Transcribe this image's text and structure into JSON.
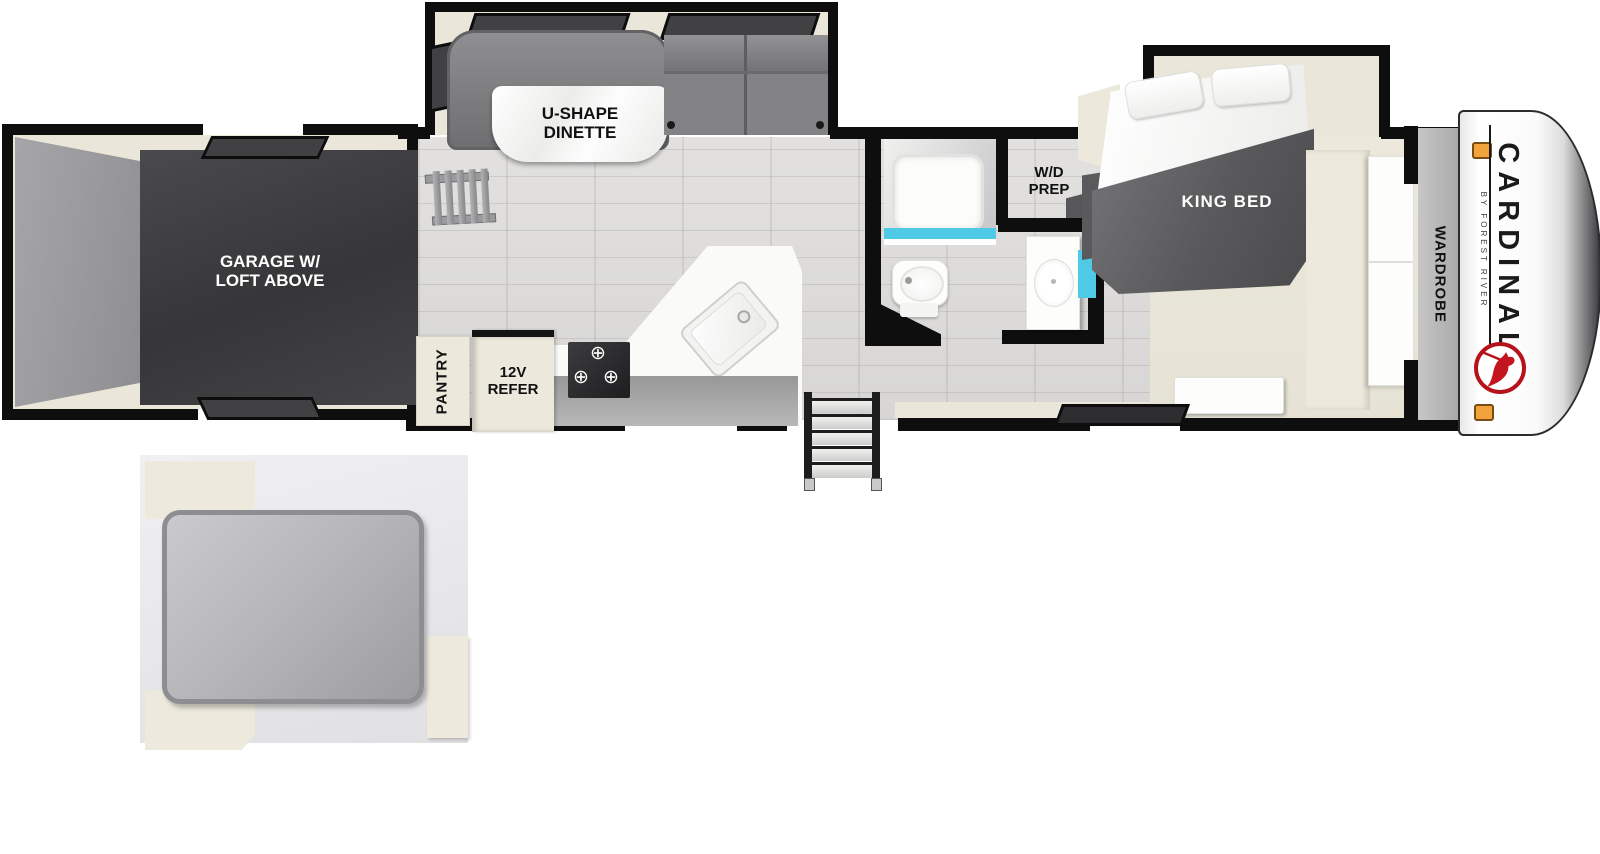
{
  "floorplan": {
    "garage": {
      "line1": "GARAGE W/",
      "line2": "LOFT ABOVE"
    },
    "dinette": {
      "line1": "U-SHAPE",
      "line2": "DINETTE"
    },
    "kitchen": {
      "pantry": "PANTRY",
      "refer_line1": "12V",
      "refer_line2": "REFER"
    },
    "bath": {
      "wd_line1": "W/D",
      "wd_line2": "PREP"
    },
    "bedroom": {
      "king": "KING BED",
      "wardrobe": "WARDROBE"
    },
    "brand": {
      "name": "CARDINAL",
      "byline": "BY FOREST RIVER"
    }
  },
  "icons": {
    "burner": "⊕"
  },
  "colors": {
    "wall": "#0e0e0e",
    "trim_cream": "#eae7da",
    "garage_floor": "#3d3d3f",
    "ramp_gray": "#9b9b9d",
    "furniture_gray": "#7c7c7e",
    "accent_cyan": "#4ec9e6",
    "brand_red": "#b5121b",
    "marker_orange": "#f3a33b",
    "mattress_gray": "#b3b3b5"
  }
}
